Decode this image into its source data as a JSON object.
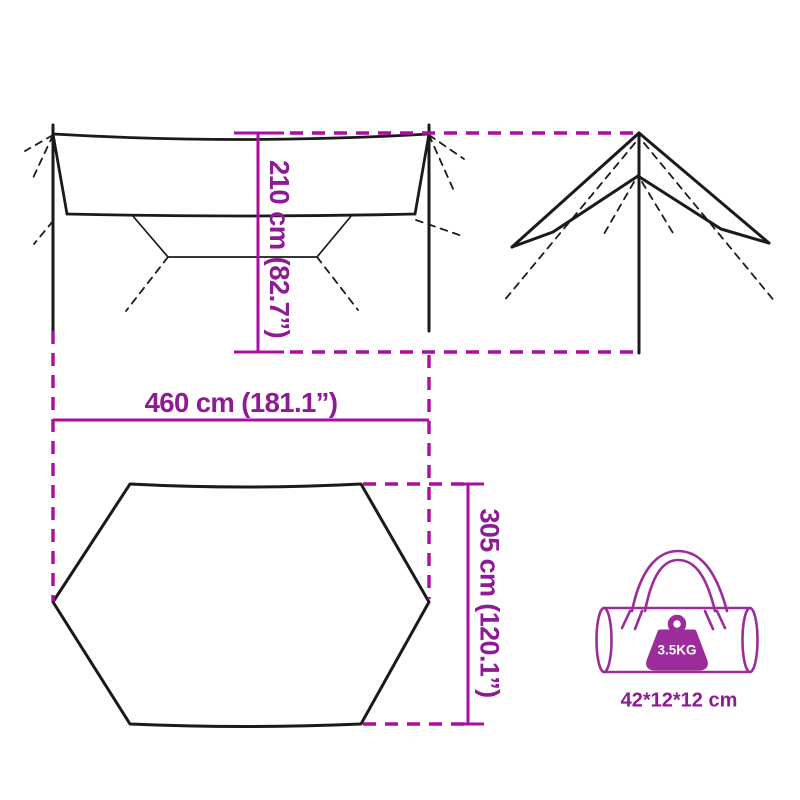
{
  "diagram": {
    "dimensions": {
      "height_label": "210 cm (82.7”)",
      "width_label": "460 cm (181.1”)",
      "depth_label": "305 cm (120.1”)"
    },
    "bag": {
      "weight_label": "3.5KG",
      "size_label": "42*12*12 cm"
    },
    "colors": {
      "dimension_line": "#AD0BA3",
      "dimension_text": "#8E1A94",
      "bag_accent": "#9B2D9B",
      "drawing_line": "#1A1A1A",
      "weight_text": "#FFFFFF",
      "background": "#FFFFFF"
    }
  }
}
